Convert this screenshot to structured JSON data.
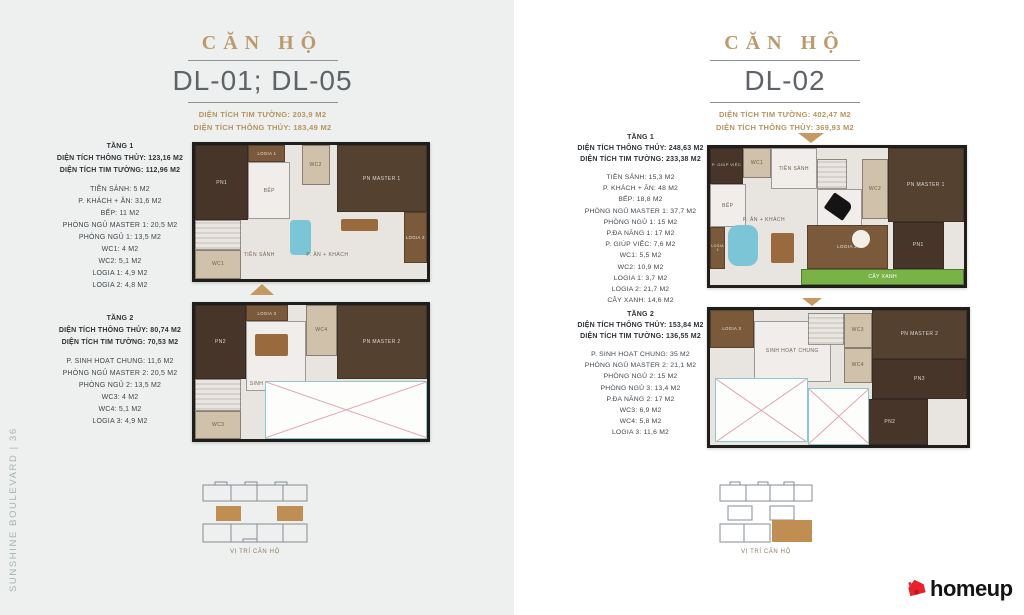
{
  "page": {
    "sidebar_text": "SUNSHINE BOULEVARD | 36",
    "brand_name": "homeup",
    "brand_color": "#e8222b",
    "accent_gold": "#b8935e",
    "highlight_tan": "#c08d52",
    "left_bg": "#edf0ee",
    "right_bg": "#ffffff"
  },
  "left_unit": {
    "title": "CĂN HỘ",
    "code": "DL-01; DL-05",
    "area_line1": "DIỆN TÍCH TIM TƯỜNG: 203,9 M2",
    "area_line2": "DIỆN TÍCH THÔNG THỦY: 183,49 M2",
    "key_plan_caption": "VỊ TRÍ CĂN HỘ",
    "floors": [
      {
        "name": "TẦNG 1",
        "line1": "DIỆN TÍCH THÔNG THỦY: 123,16 M2",
        "line2": "DIỆN TÍCH TIM TƯỜNG: 112,96 M2",
        "rooms": [
          "TIỀN SẢNH: 5 M2",
          "P. KHÁCH + ĂN: 31,6 M2",
          "BẾP: 11 M2",
          "PHÒNG NGỦ MASTER 1: 20,5 M2",
          "PHÒNG NGỦ 1: 13,5 M2",
          "WC1: 4 M2",
          "WC2: 5,1 M2",
          "LOGIA 1: 4,9 M2",
          "LOGIA 2: 4,8 M2"
        ]
      },
      {
        "name": "TẦNG 2",
        "line1": "DIỆN TÍCH THÔNG THỦY: 80,74 M2",
        "line2": "DIỆN TÍCH TIM TƯỜNG: 70,53 M2",
        "rooms": [
          "P. SINH HOẠT CHUNG: 11,6 M2",
          "PHÒNG NGỦ MASTER 2: 20,5 M2",
          "PHÒNG NGỦ 2: 13,5 M2",
          "WC3: 4 M2",
          "WC4: 5,1 M2",
          "LOGIA 3: 4,9 M2"
        ]
      }
    ],
    "plan1_labels": {
      "pn1": "PN1",
      "logia1": "LOGIA 1",
      "bep": "BẾP",
      "wc2": "WC2",
      "pn_master1": "PN MASTER 1",
      "logia2": "LOGIA 2",
      "wc1": "WC1",
      "tien_sanh": "TIỀN SẢNH",
      "p_an_khach": "P. ĂN + KHÁCH"
    },
    "plan2_labels": {
      "pn2": "PN2",
      "logia3": "LOGIA 3",
      "sinh_hoat_chung": "SINH HOẠT CHUNG",
      "wc4": "WC4",
      "pn_master2": "PN MASTER 2",
      "wc3": "WC3"
    }
  },
  "right_unit": {
    "title": "CĂN HỘ",
    "code": "DL-02",
    "area_line1": "DIỆN TÍCH TIM TƯỜNG: 402,47 M2",
    "area_line2": "DIỆN TÍCH THÔNG THỦY: 369,93 M2",
    "key_plan_caption": "VỊ TRÍ CĂN HỘ",
    "floors": [
      {
        "name": "TẦNG 1",
        "line1": "DIỆN TÍCH THÔNG THỦY: 248,63 M2",
        "line2": "DIỆN TÍCH TIM TƯỜNG: 233,38 M2",
        "rooms": [
          "TIỀN SẢNH: 15,3 M2",
          "P. KHÁCH + ĂN: 48 M2",
          "BẾP: 18,8 M2",
          "PHÒNG NGỦ MASTER 1: 37,7 M2",
          "PHÒNG NGỦ 1: 15 M2",
          "P.ĐA NĂNG 1: 17 M2",
          "P. GIÚP VIỆC: 7,6 M2",
          "WC1: 5,5 M2",
          "WC2: 10,9 M2",
          "LOGIA 1: 3,7 M2",
          "LOGIA 2: 21,7 M2",
          "CÂY XANH: 14,6 M2"
        ]
      },
      {
        "name": "TẦNG 2",
        "line1": "DIỆN TÍCH THÔNG THỦY: 153,84 M2",
        "line2": "DIỆN TÍCH TIM TƯỜNG: 136,55 M2",
        "rooms": [
          "P. SINH HOẠT CHUNG: 35 M2",
          "PHÒNG NGỦ MASTER 2: 21,1 M2",
          "PHÒNG NGỦ 2: 15 M2",
          "PHÒNG NGỦ 3: 13,4 M2",
          "P.ĐA NĂNG 2: 17 M2",
          "WC3: 6,9 M2",
          "WC4: 5,8 M2",
          "LOGIA 3: 11,6 M2"
        ]
      }
    ],
    "plan1_labels": {
      "giup_viec": "P. GIÚP VIỆC",
      "wc1": "WC1",
      "tien_sanh": "TIỀN SẢNH",
      "bep": "BẾP",
      "logia1": "LOGIA 1",
      "p_an_khach": "P. ĂN + KHÁCH",
      "da_nang": "P. ĐA NĂNG 1",
      "wc2": "WC2",
      "pn_master1": "PN MASTER 1",
      "pn1": "PN1",
      "logia2": "LOGIA 2",
      "cay_xanh": "CÂY XANH"
    },
    "plan2_labels": {
      "logia3": "LOGIA 3",
      "sinh_hoat_chung": "SINH HOẠT CHUNG",
      "wc3": "WC3",
      "wc4": "WC4",
      "pn_master2": "PN MASTER 2",
      "pn3": "PN3",
      "pn2": "PN2"
    }
  }
}
